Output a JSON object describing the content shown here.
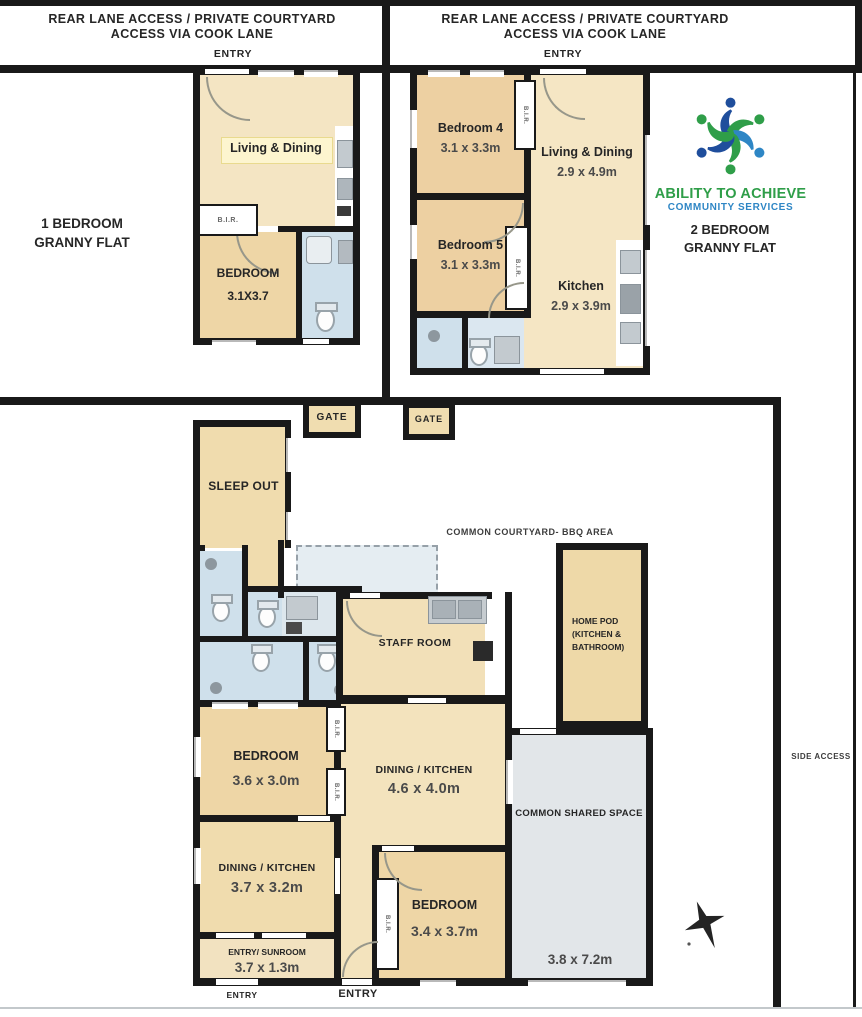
{
  "palette": {
    "wall": "#191919",
    "tan_dark": "#edd0a2",
    "tan_light": "#f5e6c4",
    "bath_blue": "#cfe0eb",
    "common_grey": "#e2e6e9",
    "logo_green": "#2F9E49",
    "logo_navy": "#1F4E9C",
    "logo_blue": "#2E86C5"
  },
  "top_left_unit": {
    "header": {
      "line1": "REAR LANE ACCESS / PRIVATE COURTYARD",
      "line2": "ACCESS VIA COOK LANE"
    },
    "entry_label": "ENTRY",
    "title_line1": "1 BEDROOM",
    "title_line2": "GRANNY FLAT",
    "living_label": "Living & Dining",
    "bir_label": "B.I.R.",
    "bedroom_label": "BEDROOM",
    "bedroom_dims": "3.1X3.7"
  },
  "top_right_unit": {
    "header": {
      "line1": "REAR LANE ACCESS / PRIVATE COURTYARD",
      "line2": "ACCESS VIA COOK LANE"
    },
    "entry_label": "ENTRY",
    "title_line1": "2 BEDROOM",
    "title_line2": "GRANNY FLAT",
    "bedroom4_label": "Bedroom 4",
    "bedroom4_dims": "3.1 x 3.3m",
    "living_label": "Living & Dining",
    "living_dims": "2.9 x 4.9m",
    "bedroom5_label": "Bedroom 5",
    "bedroom5_dims": "3.1 x 3.3m",
    "kitchen_label": "Kitchen",
    "kitchen_dims": "2.9 x 3.9m",
    "bir_label": "B.I.R."
  },
  "logo": {
    "org_name": "ABILITY TO ACHIEVE",
    "tagline": "COMMUNITY SERVICES"
  },
  "site": {
    "gate_left_label": "GATE",
    "gate_right_label": "GATE",
    "courtyard_label": "COMMON COURTYARD- BBQ AREA",
    "side_access_label": "SIDE ACCESS"
  },
  "main_house": {
    "sleep_out_label": "SLEEP OUT",
    "staff_room_label": "STAFF ROOM",
    "home_pod": {
      "line1": "HOME POD",
      "line2": "(KITCHEN &",
      "line3": "BATHROOM)"
    },
    "bedroom_nw_label": "BEDROOM",
    "bedroom_nw_dims": "3.6 x 3.0m",
    "dining_mid_label": "DINING / KITCHEN",
    "dining_mid_dims": "4.6 x 4.0m",
    "dining_sw_label": "DINING / KITCHEN",
    "dining_sw_dims": "3.7 x 3.2m",
    "sunroom_label": "ENTRY/ SUNROOM",
    "sunroom_dims": "3.7 x 1.3m",
    "bedroom_s_label": "BEDROOM",
    "bedroom_s_dims": "3.4 x 3.7m",
    "common_label": "COMMON SHARED SPACE",
    "common_dims": "3.8 x 7.2m",
    "entry_left_label": "ENTRY",
    "entry_mid_label": "ENTRY",
    "bir_label": "B.I.R."
  }
}
